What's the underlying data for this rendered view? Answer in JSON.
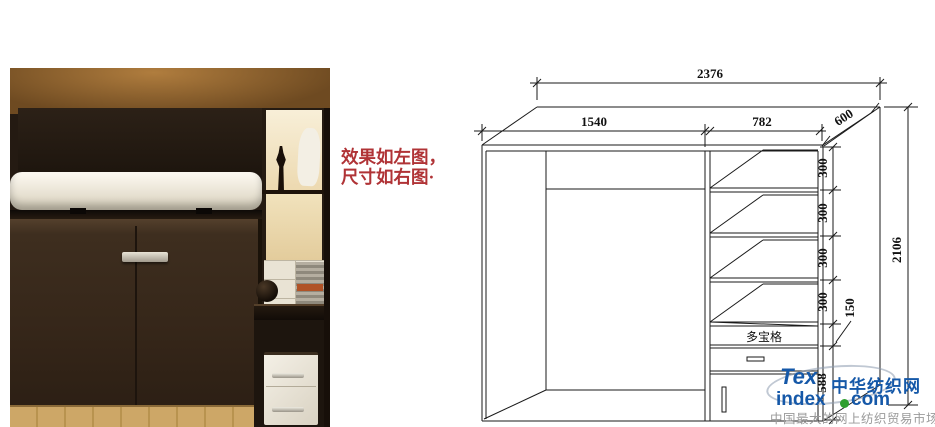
{
  "annotation": {
    "line1": "效果如左图，",
    "line2": "尺寸如右图·",
    "color": "#b03336"
  },
  "diagram": {
    "dim_total_width": "2376",
    "dim_left_width": "1540",
    "dim_right_width": "782",
    "dim_depth": "600",
    "shelf_dims": [
      "300",
      "300",
      "300",
      "300"
    ],
    "dim_small_cell": "150",
    "dim_bottom_section": "588",
    "dim_total_height": "2106",
    "compartment_label": "多宝格",
    "axis_label": "Y",
    "line_color": "#1a1a1a"
  },
  "watermark": {
    "logo_top": "Tex",
    "logo_index": "index",
    "logo_com": "com",
    "site_name": "中华纺织网",
    "tagline": "中国最大的网上纺织贸易市场",
    "blue": "#1558a8",
    "green": "#2f9e2f",
    "gray": "#9a9a9a"
  }
}
